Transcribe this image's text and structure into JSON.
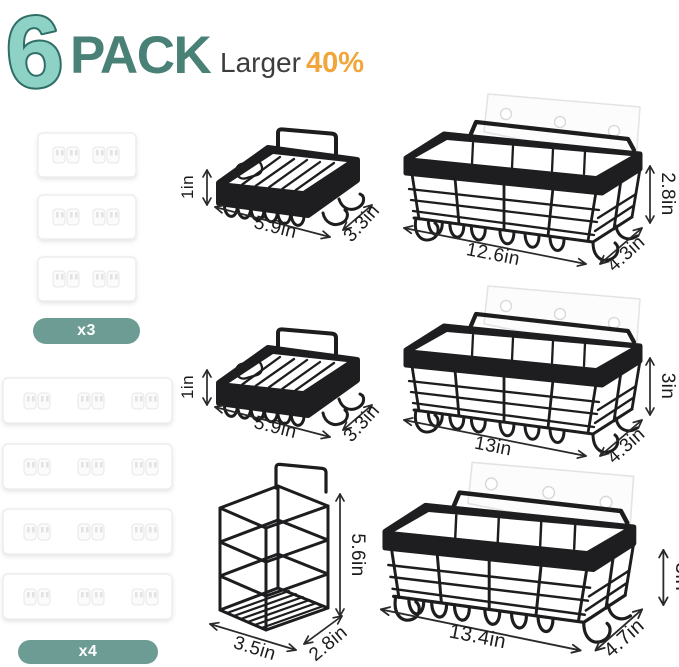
{
  "header": {
    "count": "6",
    "pack": "PACK",
    "larger": "Larger",
    "percent": "40%"
  },
  "badges": {
    "small_pads": "x3",
    "long_strips": "x4"
  },
  "adhesives": {
    "small_pad_quantity": 3,
    "long_strip_quantity": 4
  },
  "products": {
    "soap_dish_top": {
      "height": "1in",
      "width": "5.9in",
      "depth": "3.3in"
    },
    "soap_dish_mid": {
      "height": "1in",
      "width": "5.9in",
      "depth": "3.3in"
    },
    "caddy_top": {
      "height": "2.8in",
      "width": "12.6in",
      "depth": "4.3in"
    },
    "caddy_mid": {
      "height": "3in",
      "width": "13in",
      "depth": "4.3in"
    },
    "caddy_bottom": {
      "height": "3in",
      "width": "13.4in",
      "depth": "4.7in"
    },
    "toothbrush_holder": {
      "height": "5.6in",
      "width": "3.5in",
      "depth": "2.8in"
    }
  },
  "colors": {
    "teal_dark": "#4a8177",
    "teal_light": "#8ed1c5",
    "teal_outline": "#2f6e66",
    "badge_teal": "#6d9c94",
    "accent_orange": "#f1a63c",
    "product_black": "#1d1d1f",
    "dimension_text": "#1c1c1c"
  }
}
